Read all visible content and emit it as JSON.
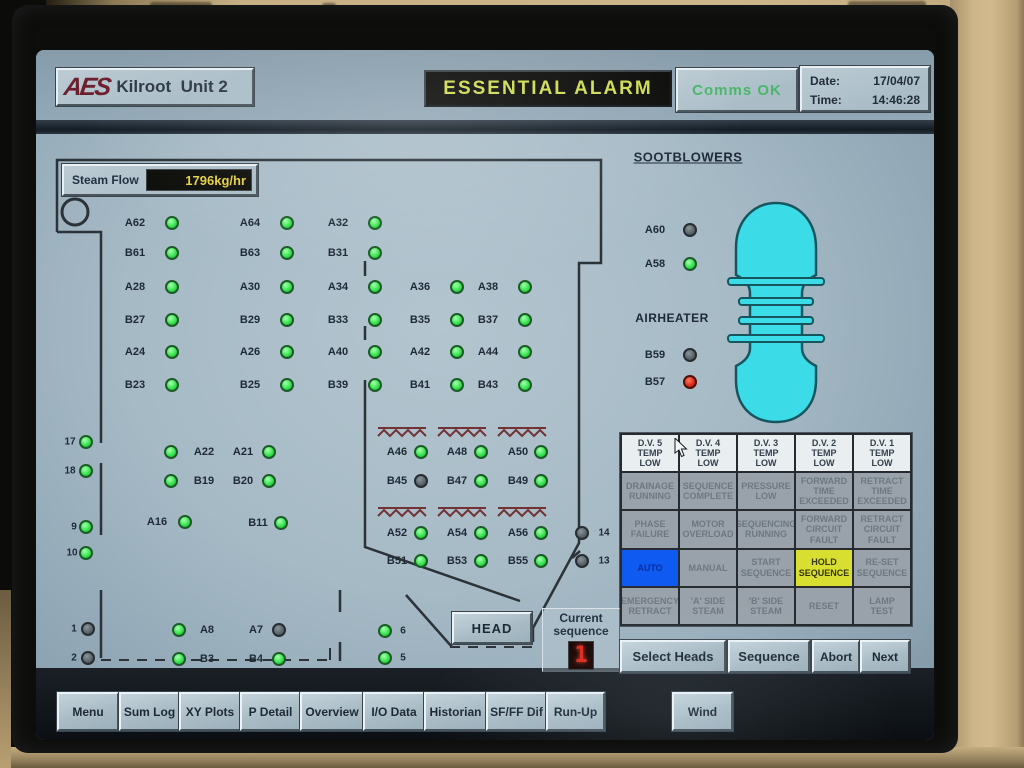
{
  "window": {
    "brand": "AES",
    "title": "Kilroot  Unit 2"
  },
  "header": {
    "alarm_banner": "ESSENTIAL ALARM",
    "comms_status": "Comms OK",
    "date_label": "Date:",
    "date_value": "17/04/07",
    "time_label": "Time:",
    "time_value": "14:46:28"
  },
  "steam_flow": {
    "label": "Steam Flow",
    "value": "1796kg/hr"
  },
  "sections": {
    "sootblowers_title": "SOOTBLOWERS",
    "airheater_title": "AIRHEATER"
  },
  "colors": {
    "led_on": "#38e44e",
    "led_off": "#59646b",
    "led_alarm": "#d8291b",
    "alarm_banner_text": "#cedc52",
    "comms_ok_text": "#49b769",
    "steam_value_text": "#e5d043",
    "vessel_fill": "#3bdce8",
    "auto_active_bg": "#0f5af0",
    "hold_active_bg": "#d8df30",
    "hatch": "#703232"
  },
  "indicators": [
    {
      "id": "A62",
      "lx": 135,
      "cx": 172,
      "y": 223,
      "st": "on"
    },
    {
      "id": "A64",
      "lx": 250,
      "cx": 287,
      "y": 223,
      "st": "on"
    },
    {
      "id": "A32",
      "lx": 338,
      "cx": 375,
      "y": 223,
      "st": "on"
    },
    {
      "id": "B61",
      "lx": 135,
      "cx": 172,
      "y": 253,
      "st": "on"
    },
    {
      "id": "B63",
      "lx": 250,
      "cx": 287,
      "y": 253,
      "st": "on"
    },
    {
      "id": "B31",
      "lx": 338,
      "cx": 375,
      "y": 253,
      "st": "on"
    },
    {
      "id": "A28",
      "lx": 135,
      "cx": 172,
      "y": 287,
      "st": "on"
    },
    {
      "id": "A30",
      "lx": 250,
      "cx": 287,
      "y": 287,
      "st": "on"
    },
    {
      "id": "A34",
      "lx": 338,
      "cx": 375,
      "y": 287,
      "st": "on"
    },
    {
      "id": "A36",
      "lx": 420,
      "cx": 457,
      "y": 287,
      "st": "on"
    },
    {
      "id": "A38",
      "lx": 488,
      "cx": 525,
      "y": 287,
      "st": "on"
    },
    {
      "id": "B27",
      "lx": 135,
      "cx": 172,
      "y": 320,
      "st": "on"
    },
    {
      "id": "B29",
      "lx": 250,
      "cx": 287,
      "y": 320,
      "st": "on"
    },
    {
      "id": "B33",
      "lx": 338,
      "cx": 375,
      "y": 320,
      "st": "on"
    },
    {
      "id": "B35",
      "lx": 420,
      "cx": 457,
      "y": 320,
      "st": "on"
    },
    {
      "id": "B37",
      "lx": 488,
      "cx": 525,
      "y": 320,
      "st": "on"
    },
    {
      "id": "A24",
      "lx": 135,
      "cx": 172,
      "y": 352,
      "st": "on"
    },
    {
      "id": "A26",
      "lx": 250,
      "cx": 287,
      "y": 352,
      "st": "on"
    },
    {
      "id": "A40",
      "lx": 338,
      "cx": 375,
      "y": 352,
      "st": "on"
    },
    {
      "id": "A42",
      "lx": 420,
      "cx": 457,
      "y": 352,
      "st": "on"
    },
    {
      "id": "A44",
      "lx": 488,
      "cx": 525,
      "y": 352,
      "st": "on"
    },
    {
      "id": "B23",
      "lx": 135,
      "cx": 172,
      "y": 385,
      "st": "on"
    },
    {
      "id": "B25",
      "lx": 250,
      "cx": 287,
      "y": 385,
      "st": "on"
    },
    {
      "id": "B39",
      "lx": 338,
      "cx": 375,
      "y": 385,
      "st": "on"
    },
    {
      "id": "B41",
      "lx": 420,
      "cx": 457,
      "y": 385,
      "st": "on"
    },
    {
      "id": "B43",
      "lx": 488,
      "cx": 525,
      "y": 385,
      "st": "on"
    },
    {
      "id": "A22",
      "lx": 204,
      "cx": 171,
      "y": 452,
      "st": "on"
    },
    {
      "id": "A21",
      "lx": 243,
      "cx": 269,
      "y": 452,
      "st": "on"
    },
    {
      "id": "B19",
      "lx": 204,
      "cx": 171,
      "y": 481,
      "st": "on"
    },
    {
      "id": "B20",
      "lx": 243,
      "cx": 269,
      "y": 481,
      "st": "on"
    },
    {
      "id": "A16",
      "lx": 157,
      "cx": 185,
      "y": 522,
      "st": "on"
    },
    {
      "id": "B11",
      "lx": 258,
      "cx": 281,
      "y": 523,
      "st": "on"
    },
    {
      "id": "A46",
      "lx": 397,
      "cx": 421,
      "y": 452,
      "st": "on"
    },
    {
      "id": "A48",
      "lx": 457,
      "cx": 481,
      "y": 452,
      "st": "on"
    },
    {
      "id": "A50",
      "lx": 518,
      "cx": 541,
      "y": 452,
      "st": "on"
    },
    {
      "id": "B45",
      "lx": 397,
      "cx": 421,
      "y": 481,
      "st": "off"
    },
    {
      "id": "B47",
      "lx": 457,
      "cx": 481,
      "y": 481,
      "st": "on"
    },
    {
      "id": "B49",
      "lx": 518,
      "cx": 541,
      "y": 481,
      "st": "on"
    },
    {
      "id": "A52",
      "lx": 397,
      "cx": 421,
      "y": 533,
      "st": "on"
    },
    {
      "id": "A54",
      "lx": 457,
      "cx": 481,
      "y": 533,
      "st": "on"
    },
    {
      "id": "A56",
      "lx": 518,
      "cx": 541,
      "y": 533,
      "st": "on"
    },
    {
      "id": "B51",
      "lx": 397,
      "cx": 421,
      "y": 561,
      "st": "on"
    },
    {
      "id": "B53",
      "lx": 457,
      "cx": 481,
      "y": 561,
      "st": "on"
    },
    {
      "id": "B55",
      "lx": 518,
      "cx": 541,
      "y": 561,
      "st": "on"
    },
    {
      "id": "A60",
      "lx": 655,
      "cx": 690,
      "y": 230,
      "st": "off"
    },
    {
      "id": "A58",
      "lx": 655,
      "cx": 690,
      "y": 264,
      "st": "on"
    },
    {
      "id": "B59",
      "lx": 655,
      "cx": 690,
      "y": 355,
      "st": "off"
    },
    {
      "id": "B57",
      "lx": 655,
      "cx": 690,
      "y": 382,
      "st": "alarm"
    },
    {
      "id": "A8",
      "lx": 207,
      "cx": 179,
      "y": 630,
      "st": "on"
    },
    {
      "id": "A7",
      "lx": 256,
      "cx": 279,
      "y": 630,
      "st": "off"
    },
    {
      "id": "B3",
      "lx": 207,
      "cx": 179,
      "y": 659,
      "st": "on"
    },
    {
      "id": "B4",
      "lx": 256,
      "cx": 279,
      "y": 659,
      "st": "on"
    },
    {
      "id": "17",
      "lx": 70,
      "cx": 86,
      "y": 442,
      "st": "on",
      "k": "n"
    },
    {
      "id": "18",
      "lx": 70,
      "cx": 86,
      "y": 471,
      "st": "on",
      "k": "n"
    },
    {
      "id": "9",
      "lx": 74,
      "cx": 86,
      "y": 527,
      "st": "on",
      "k": "n"
    },
    {
      "id": "10",
      "lx": 72,
      "cx": 86,
      "y": 553,
      "st": "on",
      "k": "n"
    },
    {
      "id": "1",
      "lx": 74,
      "cx": 88,
      "y": 629,
      "st": "off",
      "k": "n"
    },
    {
      "id": "2",
      "lx": 74,
      "cx": 88,
      "y": 658,
      "st": "off",
      "k": "n"
    },
    {
      "id": "6",
      "lx": 403,
      "cx": 385,
      "y": 631,
      "st": "on",
      "k": "n"
    },
    {
      "id": "5",
      "lx": 403,
      "cx": 385,
      "y": 658,
      "st": "on",
      "k": "n"
    },
    {
      "id": "14",
      "lx": 604,
      "cx": 582,
      "y": 533,
      "st": "off",
      "k": "n"
    },
    {
      "id": "13",
      "lx": 604,
      "cx": 582,
      "y": 561,
      "st": "off",
      "k": "n"
    }
  ],
  "alarm_matrix": {
    "rows": [
      [
        {
          "label": "D.V. 5\nTEMP\nLOW",
          "state": "lit"
        },
        {
          "label": "D.V. 4\nTEMP\nLOW",
          "state": "lit"
        },
        {
          "label": "D.V. 3\nTEMP\nLOW",
          "state": "lit"
        },
        {
          "label": "D.V. 2\nTEMP\nLOW",
          "state": "lit"
        },
        {
          "label": "D.V. 1\nTEMP\nLOW",
          "state": "lit"
        }
      ],
      [
        {
          "label": "DRAINAGE\nRUNNING",
          "state": "dim"
        },
        {
          "label": "SEQUENCE\nCOMPLETE",
          "state": "dim"
        },
        {
          "label": "PRESSURE\nLOW",
          "state": "dim"
        },
        {
          "label": "FORWARD\nTIME\nEXCEEDED",
          "state": "dim"
        },
        {
          "label": "RETRACT\nTIME\nEXCEEDED",
          "state": "dim"
        }
      ],
      [
        {
          "label": "PHASE\nFAILURE",
          "state": "dim"
        },
        {
          "label": "MOTOR\nOVERLOAD",
          "state": "dim"
        },
        {
          "label": "SEQUENCING\nRUNNING",
          "state": "dim"
        },
        {
          "label": "FORWARD\nCIRCUIT\nFAULT",
          "state": "dim"
        },
        {
          "label": "RETRACT\nCIRCUIT\nFAULT",
          "state": "dim"
        }
      ],
      [
        {
          "label": "AUTO",
          "state": "blue"
        },
        {
          "label": "MANUAL",
          "state": "dim"
        },
        {
          "label": "START\nSEQUENCE",
          "state": "dim"
        },
        {
          "label": "HOLD\nSEQUENCE",
          "state": "yellow"
        },
        {
          "label": "RE-SET\nSEQUENCE",
          "state": "dim"
        }
      ],
      [
        {
          "label": "EMERGENCY\nRETRACT",
          "state": "dim"
        },
        {
          "label": "'A' SIDE\nSTEAM",
          "state": "dim"
        },
        {
          "label": "'B' SIDE\nSTEAM",
          "state": "dim"
        },
        {
          "label": "RESET",
          "state": "dim"
        },
        {
          "label": "LAMP\nTEST",
          "state": "dim"
        }
      ]
    ]
  },
  "controls": {
    "head": "HEAD",
    "select_heads": "Select Heads",
    "sequence": "Sequence",
    "abort": "Abort",
    "next": "Next",
    "current_sequence_label": "Current\nsequence",
    "current_sequence_value": "1"
  },
  "toolbar": {
    "items": [
      {
        "label": "Menu",
        "x": 21,
        "w": 58
      },
      {
        "label": "Sum Log",
        "x": 83,
        "w": 57
      },
      {
        "label": "XY Plots",
        "x": 143,
        "w": 58
      },
      {
        "label": "P Detail",
        "x": 204,
        "w": 57
      },
      {
        "label": "Overview",
        "x": 264,
        "w": 60
      },
      {
        "label": "I/O Data",
        "x": 327,
        "w": 58
      },
      {
        "label": "Historian",
        "x": 388,
        "w": 59
      },
      {
        "label": "SF/FF Dif",
        "x": 450,
        "w": 57
      },
      {
        "label": "Run-Up",
        "x": 510,
        "w": 55
      },
      {
        "label": "Wind",
        "x": 636,
        "w": 57
      }
    ]
  }
}
